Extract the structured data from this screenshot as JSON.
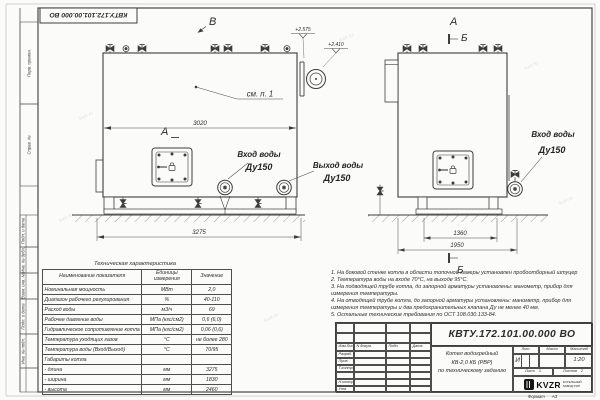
{
  "watermark": "kvzr.ru",
  "frame": {
    "doc_number_top": "КВТУ.172.101.00.000 ВО",
    "stamps": [
      "Перв. примен.",
      "Справ. №",
      "Подп. и дата",
      "Инв. № дубл.",
      "Взам. инв. №",
      "Подп. и дата",
      "Инв. № подл."
    ]
  },
  "drawing": {
    "view_b": "В",
    "view_a": "А",
    "section_b": "Б",
    "see_note": "см. п. 1",
    "elev_1": "+2.575",
    "elev_2": "+2.410",
    "dim_width": "3020",
    "dim_length": "3275",
    "dim_1360": "1360",
    "dim_1950": "1950",
    "inlet": {
      "l1": "Вход воды",
      "l2": "Ду150"
    },
    "outlet": {
      "l1": "Выход воды",
      "l2": "Ду150"
    }
  },
  "spec_table": {
    "title": "Техническая характеристика",
    "headers": [
      "Наименование показателя",
      "Единицы измерения",
      "Значение"
    ],
    "rows": [
      [
        "Номинальная мощность",
        "МВт",
        "2,0"
      ],
      [
        "Диапазон рабочего регулирования",
        "%",
        "40-110"
      ],
      [
        "Расход воды",
        "м3/ч",
        "69"
      ],
      [
        "Рабочее давление воды",
        "МПа (кгс/см2)",
        "0,6 (6,0)"
      ],
      [
        "Гидравлическое сопротивление котла",
        "МПа (кгс/см2)",
        "0,06 (0,6)"
      ],
      [
        "Температура уходящих газов",
        "°С",
        "не более 280"
      ],
      [
        "Температура воды (Вход/Выход)",
        "°С",
        "70/95"
      ],
      [
        "Габариты котла",
        "",
        ""
      ],
      [
        "- длина",
        "мм",
        "3275"
      ],
      [
        "- ширина",
        "мм",
        "1830"
      ],
      [
        "- высота",
        "мм",
        "2460"
      ]
    ]
  },
  "notes": [
    "1. На боковой стенке котла в области топочной камеры установлен пробоотборный штуцер",
    "2. Температура воды на входе 70°С, на выходе 95°С.",
    "3. На подводящей трубе котла, до запорной арматуры установлены: манометр, прибор для измерения температуры.",
    "4. На отводящей трубе котла, до запорной арматуры установлены: манометр, прибор для измерения температуры и два предохранительных клапана Ду не менее 40 мм.",
    "5. Остальные технические требования по ОСТ 108.030.133-84."
  ],
  "title_block": {
    "doc_number": "КВТУ.172.101.00.000  ВО",
    "header_cols": [
      "Изм.Лист",
      "N докум.",
      "Подп.",
      "Дата"
    ],
    "row_labels": [
      "Разраб.",
      "Пров.",
      "Т.контр.",
      "",
      "Н.контр.",
      "Утв."
    ],
    "product_lines": [
      "Котел водогрейный",
      "КВ-2,0 КБ (РВР)",
      "по техническому заданию"
    ],
    "lit_h": "Лит.",
    "mass_h": "Масса",
    "scale_h": "Масштаб",
    "lit_v": "И",
    "scale_v": "1:20",
    "sheet_h": "Лист",
    "sheet_v": "1",
    "sheets_h": "Листов",
    "sheets_v": "2",
    "logo": "KVZR",
    "company": [
      "КОТЕЛЬНЫЙ",
      "ЗАВОД РЭП"
    ],
    "format_h": "Формат",
    "format_v": "А3"
  }
}
